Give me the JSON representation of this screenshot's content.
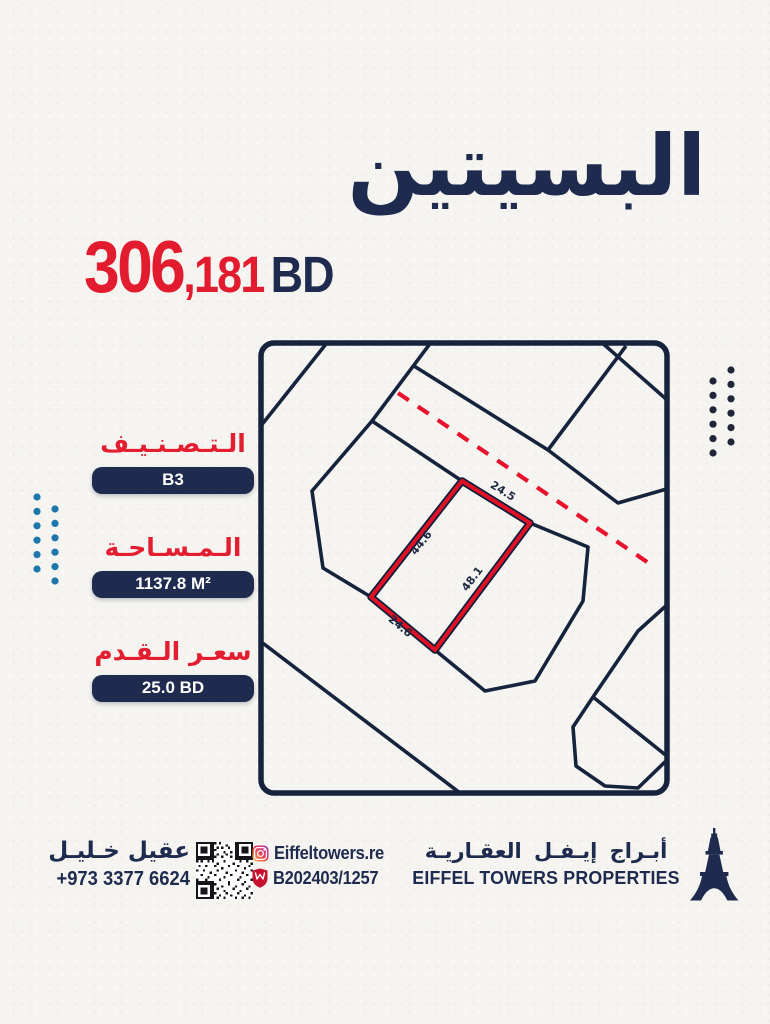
{
  "title": "البسيتين",
  "price": {
    "amount_main": "306",
    "amount_fraction": ",181",
    "currency": "BD"
  },
  "info": [
    {
      "label": "الـتـصـنـيـف",
      "value": "B3"
    },
    {
      "label": "الـمـسـاحـة",
      "value": "1137.8 M²"
    },
    {
      "label": "سعـر الـقـدم",
      "value": "25.0 BD"
    }
  ],
  "map": {
    "dimensions": {
      "top": "24.5",
      "left": "44.6",
      "right": "48.1",
      "bottom": "24.6"
    }
  },
  "footer": {
    "agent_name": "عقيل خـليـل",
    "agent_phone": "+973 3377 6624",
    "instagram_handle": "Eiffeltowers.re",
    "registration_number": "B202403/1257",
    "company_name_ar": "أبـراج إيـفـل العقـاريـة",
    "company_name_en": "EIFFEL TOWERS PROPERTIES"
  },
  "icons": {
    "instagram": "instagram-icon",
    "license_shield": "license-shield-icon",
    "qr": "qr-code",
    "eiffel_tower": "eiffel-tower-logo"
  },
  "colors": {
    "navy": "#1e2b4e",
    "map_line_navy": "#16233d",
    "red": "#e21b2e",
    "plot_red": "#df1126",
    "dots_blue": "#1d77ab",
    "dots_navy": "#20263a",
    "paper": "#f5f4f0"
  }
}
